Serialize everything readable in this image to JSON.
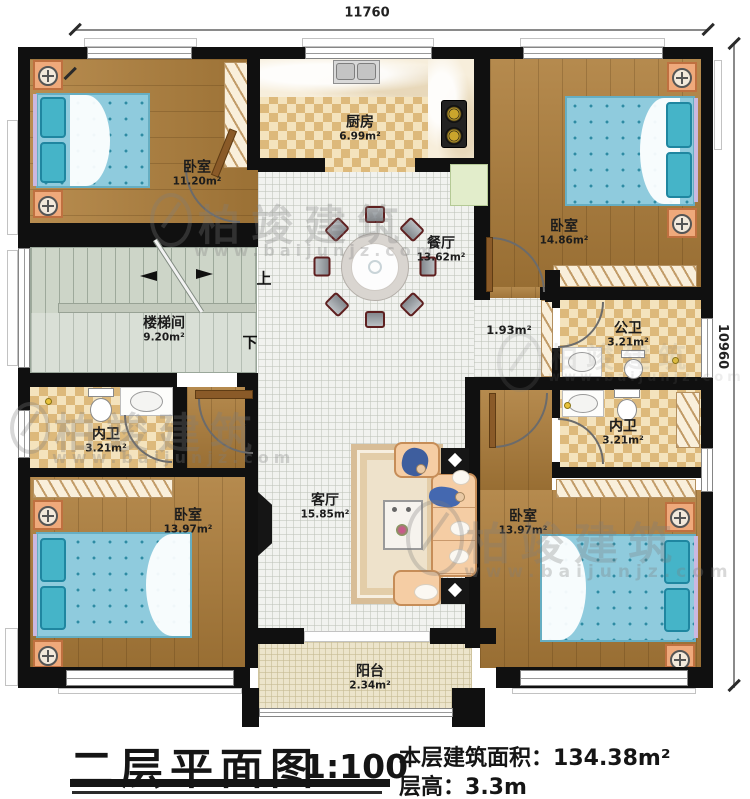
{
  "title_block": {
    "title": "二层平面图",
    "scale": "1:100",
    "area_label": "本层建筑面积：",
    "area_value": "134.38m²",
    "height_label": "层高：",
    "height_value": "3.3m"
  },
  "dimensions": {
    "width": "11760",
    "height": "10960"
  },
  "rooms": {
    "bedroom_tl": {
      "name": "卧室",
      "area": "11.20m²"
    },
    "kitchen": {
      "name": "厨房",
      "area": "6.99m²"
    },
    "bedroom_tr": {
      "name": "卧室",
      "area": "14.86m²"
    },
    "dining": {
      "name": "餐厅",
      "area": "13.62m²"
    },
    "stairwell": {
      "name": "楼梯间",
      "area": "9.20m²"
    },
    "hallway": {
      "area": "1.93m²"
    },
    "public_bath": {
      "name": "公卫",
      "area": "3.21m²"
    },
    "bath_left": {
      "name": "内卫",
      "area": "3.21m²"
    },
    "bath_right": {
      "name": "内卫",
      "area": "3.21m²"
    },
    "bedroom_bl": {
      "name": "卧室",
      "area": "13.97m²"
    },
    "living": {
      "name": "客厅",
      "area": "15.85m²"
    },
    "bedroom_br": {
      "name": "卧室",
      "area": "13.97m²"
    },
    "balcony": {
      "name": "阳台",
      "area": "2.34m²"
    }
  },
  "stairs": {
    "up": "上",
    "down": "下"
  },
  "watermark": {
    "brand": "柏竣建筑",
    "site": "www.baijunjz.com"
  },
  "colors": {
    "wall": "#101010",
    "wood": "#b0803c",
    "checker": "#ddb97b",
    "tile": "#f1f2ef",
    "stair": "#cdd5c8",
    "bed": "#8fcbdd",
    "furniture": "#f5cda4"
  }
}
